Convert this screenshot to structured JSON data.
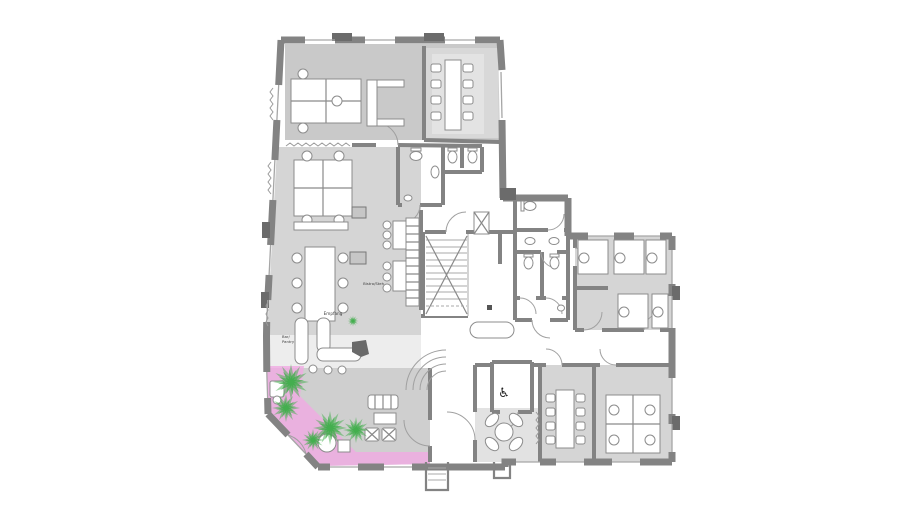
{
  "labels": {
    "reception": "Empfang",
    "bar_line1": "Bar/",
    "bar_line2": "Pantry",
    "bistro": "Bistro/Steh"
  },
  "icons": {
    "wheelchair": "♿"
  },
  "colors": {
    "wall": "#838383",
    "wall_dark": "#6b6b6b",
    "glazing": "#a6a6a6",
    "floor_top": "#c9c9c9",
    "floor": "#d5d5d5",
    "floor_light": "#e3e3e3",
    "reception_floor": "#ededed",
    "lounge_floor": "#cfcfcf",
    "lobby_floor": "#e2e2e2",
    "pink": "#f0a9e2",
    "plant": "#3fae4a",
    "furniture_stroke": "#8c8c8c",
    "text": "#3c3c3c"
  }
}
